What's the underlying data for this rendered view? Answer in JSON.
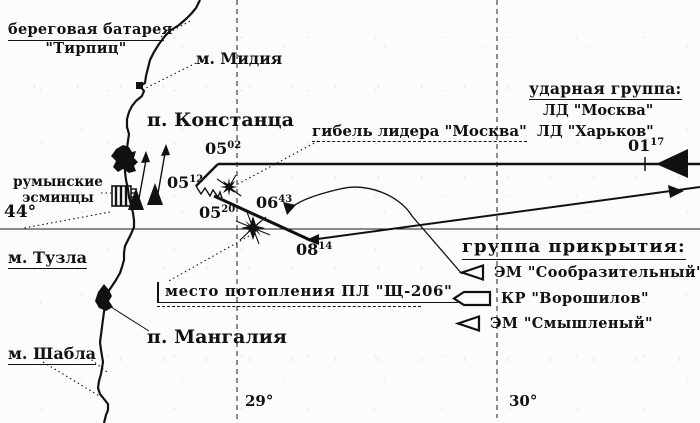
{
  "map": {
    "labels": {
      "coastal_battery_line1": "береговая батарея",
      "coastal_battery_line2": "\"Тирпиц\"",
      "cape_midia": "м. Мидия",
      "port_constanta": "п. Констанца",
      "moskva_loss": "гибель лидера \"Москва\"",
      "romanian_destroyers_line1": "румынские",
      "romanian_destroyers_line2": "эсминцы",
      "lat_44": "44°",
      "cape_tuzla": "м. Тузла",
      "sub_sinking": "место потопления ПЛ \"Щ-206\"",
      "port_mangalia": "п. Мангалия",
      "cape_shabla": "м. Шабла",
      "lon_29": "29°",
      "lon_30": "30°"
    },
    "strike_group": {
      "title": "ударная группа:",
      "ships": [
        "ЛД \"Москва\"",
        "ЛД \"Харьков\""
      ]
    },
    "cover_group": {
      "title": "группа прикрытия:",
      "ships": [
        {
          "symbol": "destroyer-symbol",
          "name": "ЭМ \"Сообразительный\""
        },
        {
          "symbol": "cruiser-symbol",
          "name": "КР \"Ворошилов\""
        },
        {
          "symbol": "destroyer-symbol",
          "name": "ЭМ \"Смышленый\""
        }
      ]
    },
    "time_marks": {
      "t0117": {
        "h": "01",
        "m": "17"
      },
      "t0502": {
        "h": "05",
        "m": "02"
      },
      "t0512": {
        "h": "05",
        "m": "12"
      },
      "t0520": {
        "h": "05",
        "m": "20"
      },
      "t0643": {
        "h": "06",
        "m": "43"
      },
      "t0814": {
        "h": "08",
        "m": "14"
      }
    },
    "colors": {
      "ink": "#111111",
      "paper": "#fcfcfa"
    }
  }
}
